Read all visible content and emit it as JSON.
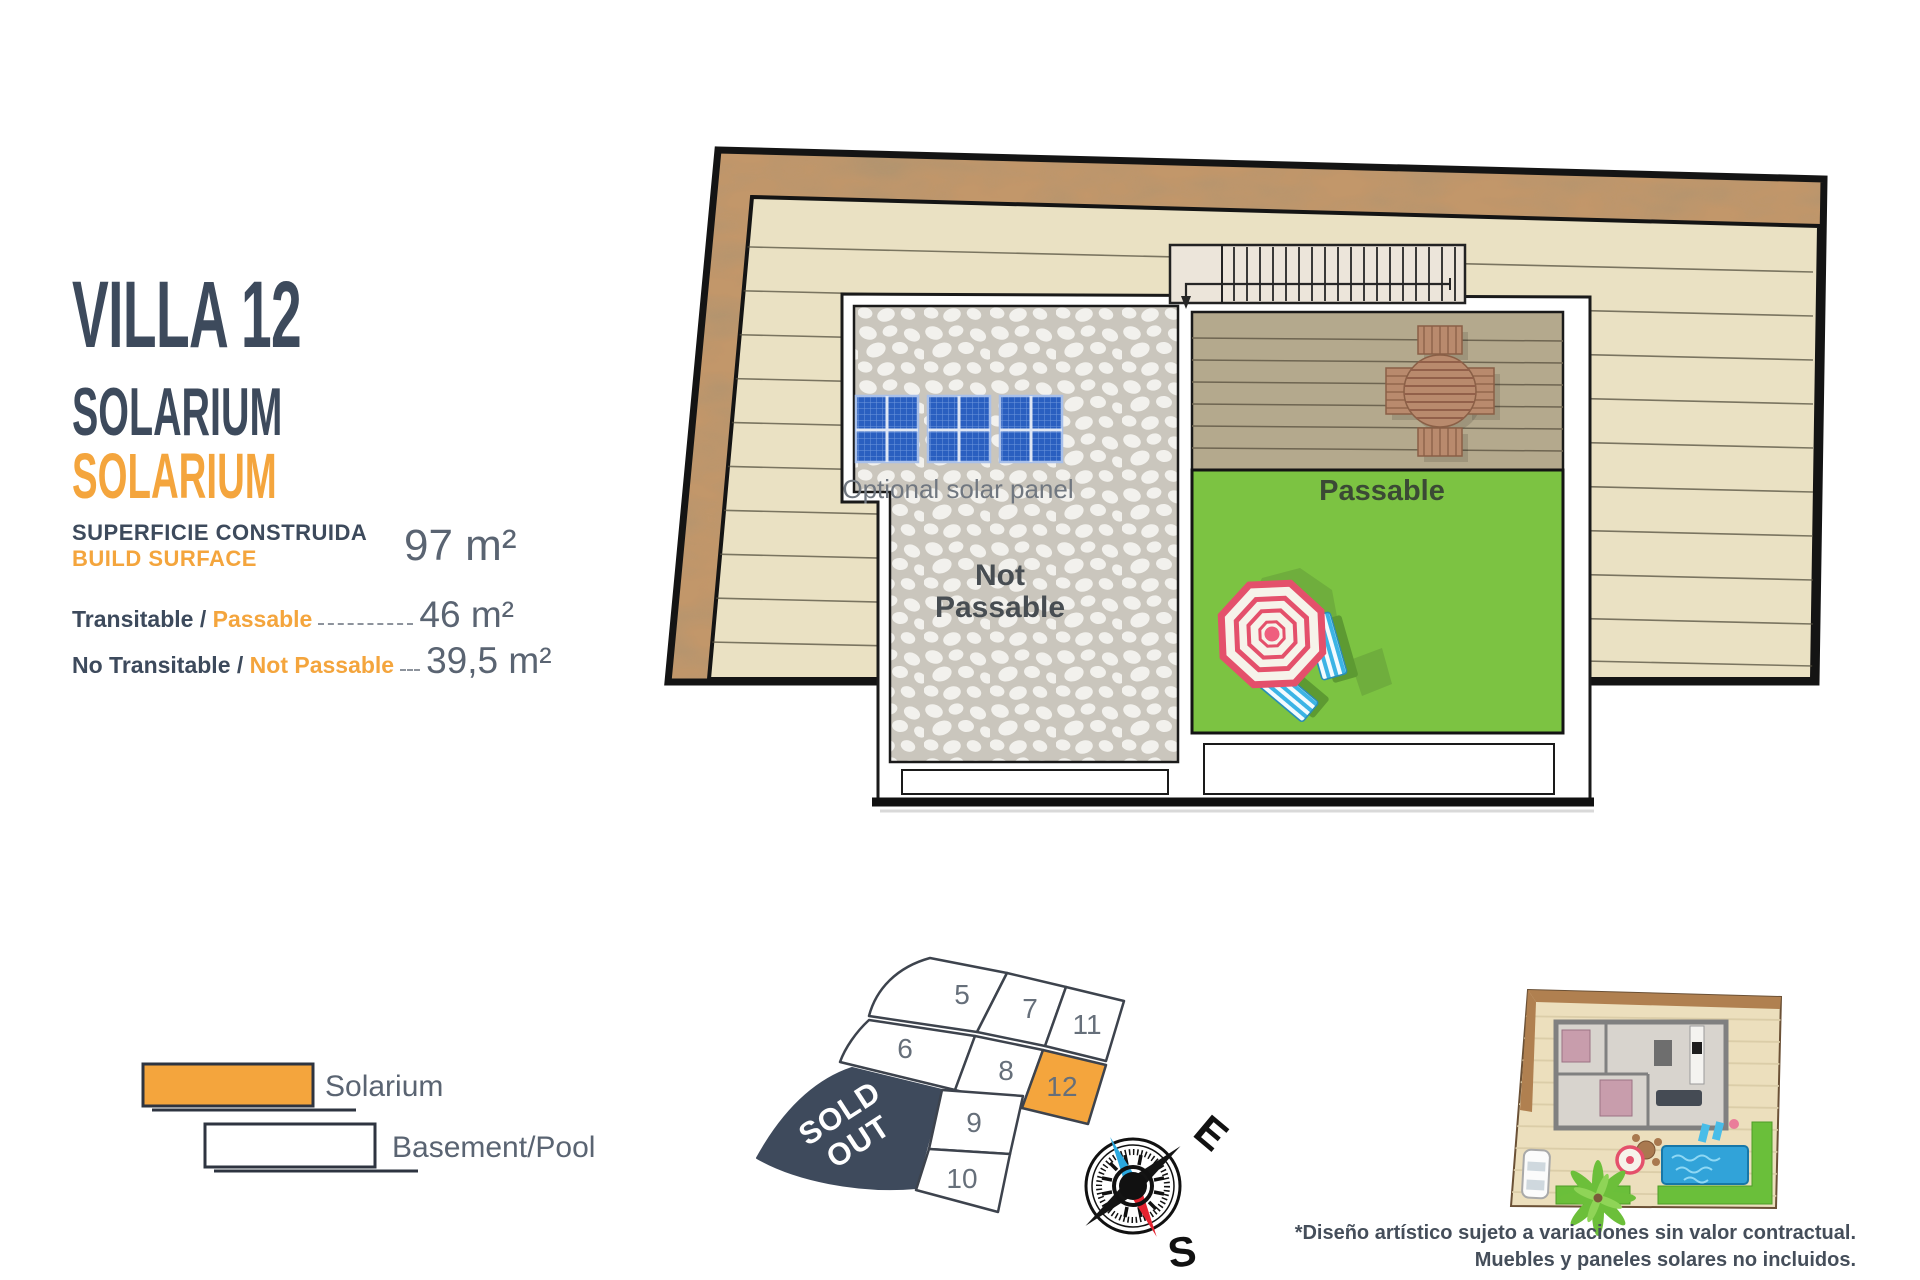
{
  "header": {
    "title": "VILLA 12",
    "subtitle": "SOLARIUM",
    "subtitle_secondary": "SOLARIUM"
  },
  "surface": {
    "built_label_es": "SUPERFICIE CONSTRUIDA",
    "built_label_en": "BUILD SURFACE",
    "built_value": "97 m²",
    "rows": [
      {
        "label_es": "Transitable / ",
        "label_en": "Passable",
        "value": "46 m²"
      },
      {
        "label_es": "No Transitable / ",
        "label_en": "Not Passable",
        "value": "39,5 m²"
      }
    ]
  },
  "plan": {
    "solar_label": "Optional solar panel",
    "not_passable_line1": "Not",
    "not_passable_line2": "Passable",
    "passable_label": "Passable"
  },
  "legend": {
    "solarium_label": "Solarium",
    "basement_label": "Basement/Pool"
  },
  "siteplan": {
    "plots": {
      "p5": "5",
      "p6": "6",
      "p7": "7",
      "p8": "8",
      "p9": "9",
      "p10": "10",
      "p11": "11",
      "p12": "12"
    },
    "sold_line1": "SOLD",
    "sold_line2": "OUT",
    "compass_east": "E",
    "compass_south": "S"
  },
  "disclaimer": {
    "line1": "*Diseño artístico sujeto a variaciones sin valor contractual.",
    "line2": "Muebles y paneles solares no incluidos."
  },
  "colors": {
    "accent_orange": "#f4a53d",
    "dark_slate": "#3d4a5c",
    "grass_green": "#7cc342",
    "roof_beige": "#eae1c3",
    "band_brown": "#c2976b",
    "deck_khaki": "#b4a98d",
    "stone_gray": "#cac6bd",
    "solar_blue": "#2a5fc0",
    "sold_navy": "#3e4a5c",
    "value_gray": "#5a6472"
  }
}
